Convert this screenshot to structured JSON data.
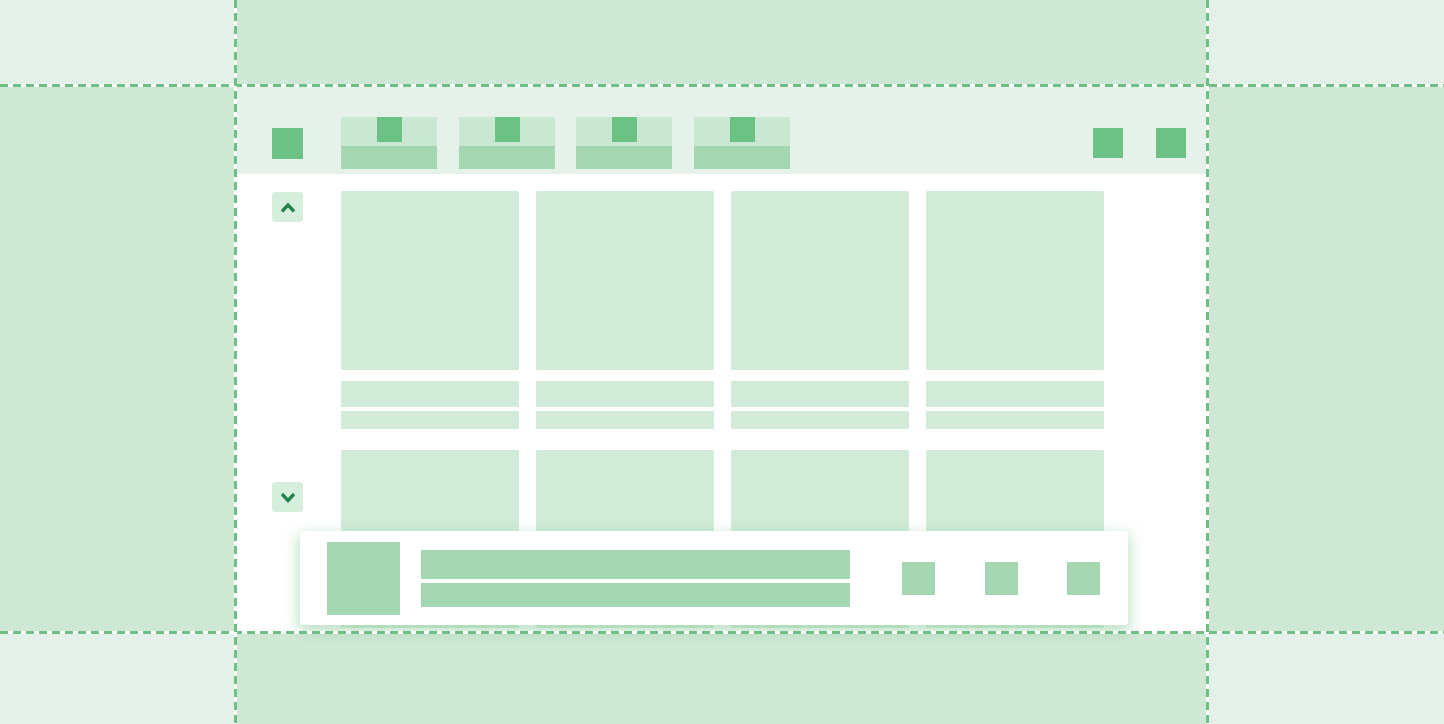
{
  "meta": {
    "description": "Stylized wireframe illustration of a browser window (tabs, content card grid, bottom notification bar) centered inside dashed layout-margin guides",
    "canvas": {
      "width": 1444,
      "height": 724
    }
  },
  "palette": {
    "page-bg": "#e4f1e8",
    "margin-band": "#cfe8d5",
    "window-bg": "#ffffff",
    "toolbar-bg": "#e6f2e9",
    "tab-top": "#c9e7d1",
    "placeholder-light": "#d2ebd8",
    "placeholder-medium": "#a4d6b1",
    "accent-square": "#6cc284",
    "button-bg": "#d6eedc",
    "chevron": "#23804a",
    "guide-dash": "#6fbe86",
    "guide-gap": "#ffffff",
    "toast-bg": "#ffffff",
    "toast-shadow": "rgba(134,203,152,0.55)"
  },
  "layout_guides": {
    "style": "dashed",
    "horizontal_lines": 2,
    "vertical_lines": 2
  },
  "browser_window": {
    "toolbar": {
      "menu_square_icon": "square-placeholder",
      "tabs": [
        {
          "favicon_icon": "square-placeholder",
          "title": ""
        },
        {
          "favicon_icon": "square-placeholder",
          "title": ""
        },
        {
          "favicon_icon": "square-placeholder",
          "title": ""
        },
        {
          "favicon_icon": "square-placeholder",
          "title": ""
        }
      ],
      "action_squares": [
        {
          "icon": "square-placeholder"
        },
        {
          "icon": "square-placeholder"
        }
      ]
    },
    "scroll_controls": {
      "up_icon": "chevron-up",
      "down_icon": "chevron-down"
    },
    "content_grid": {
      "columns": 4,
      "card_rows": 2,
      "text_lines_per_column": 2
    },
    "toast": {
      "thumbnail_icon": "square-placeholder",
      "text_lines": 2,
      "action_squares": [
        {
          "icon": "square-placeholder"
        },
        {
          "icon": "square-placeholder"
        },
        {
          "icon": "square-placeholder"
        }
      ]
    }
  }
}
